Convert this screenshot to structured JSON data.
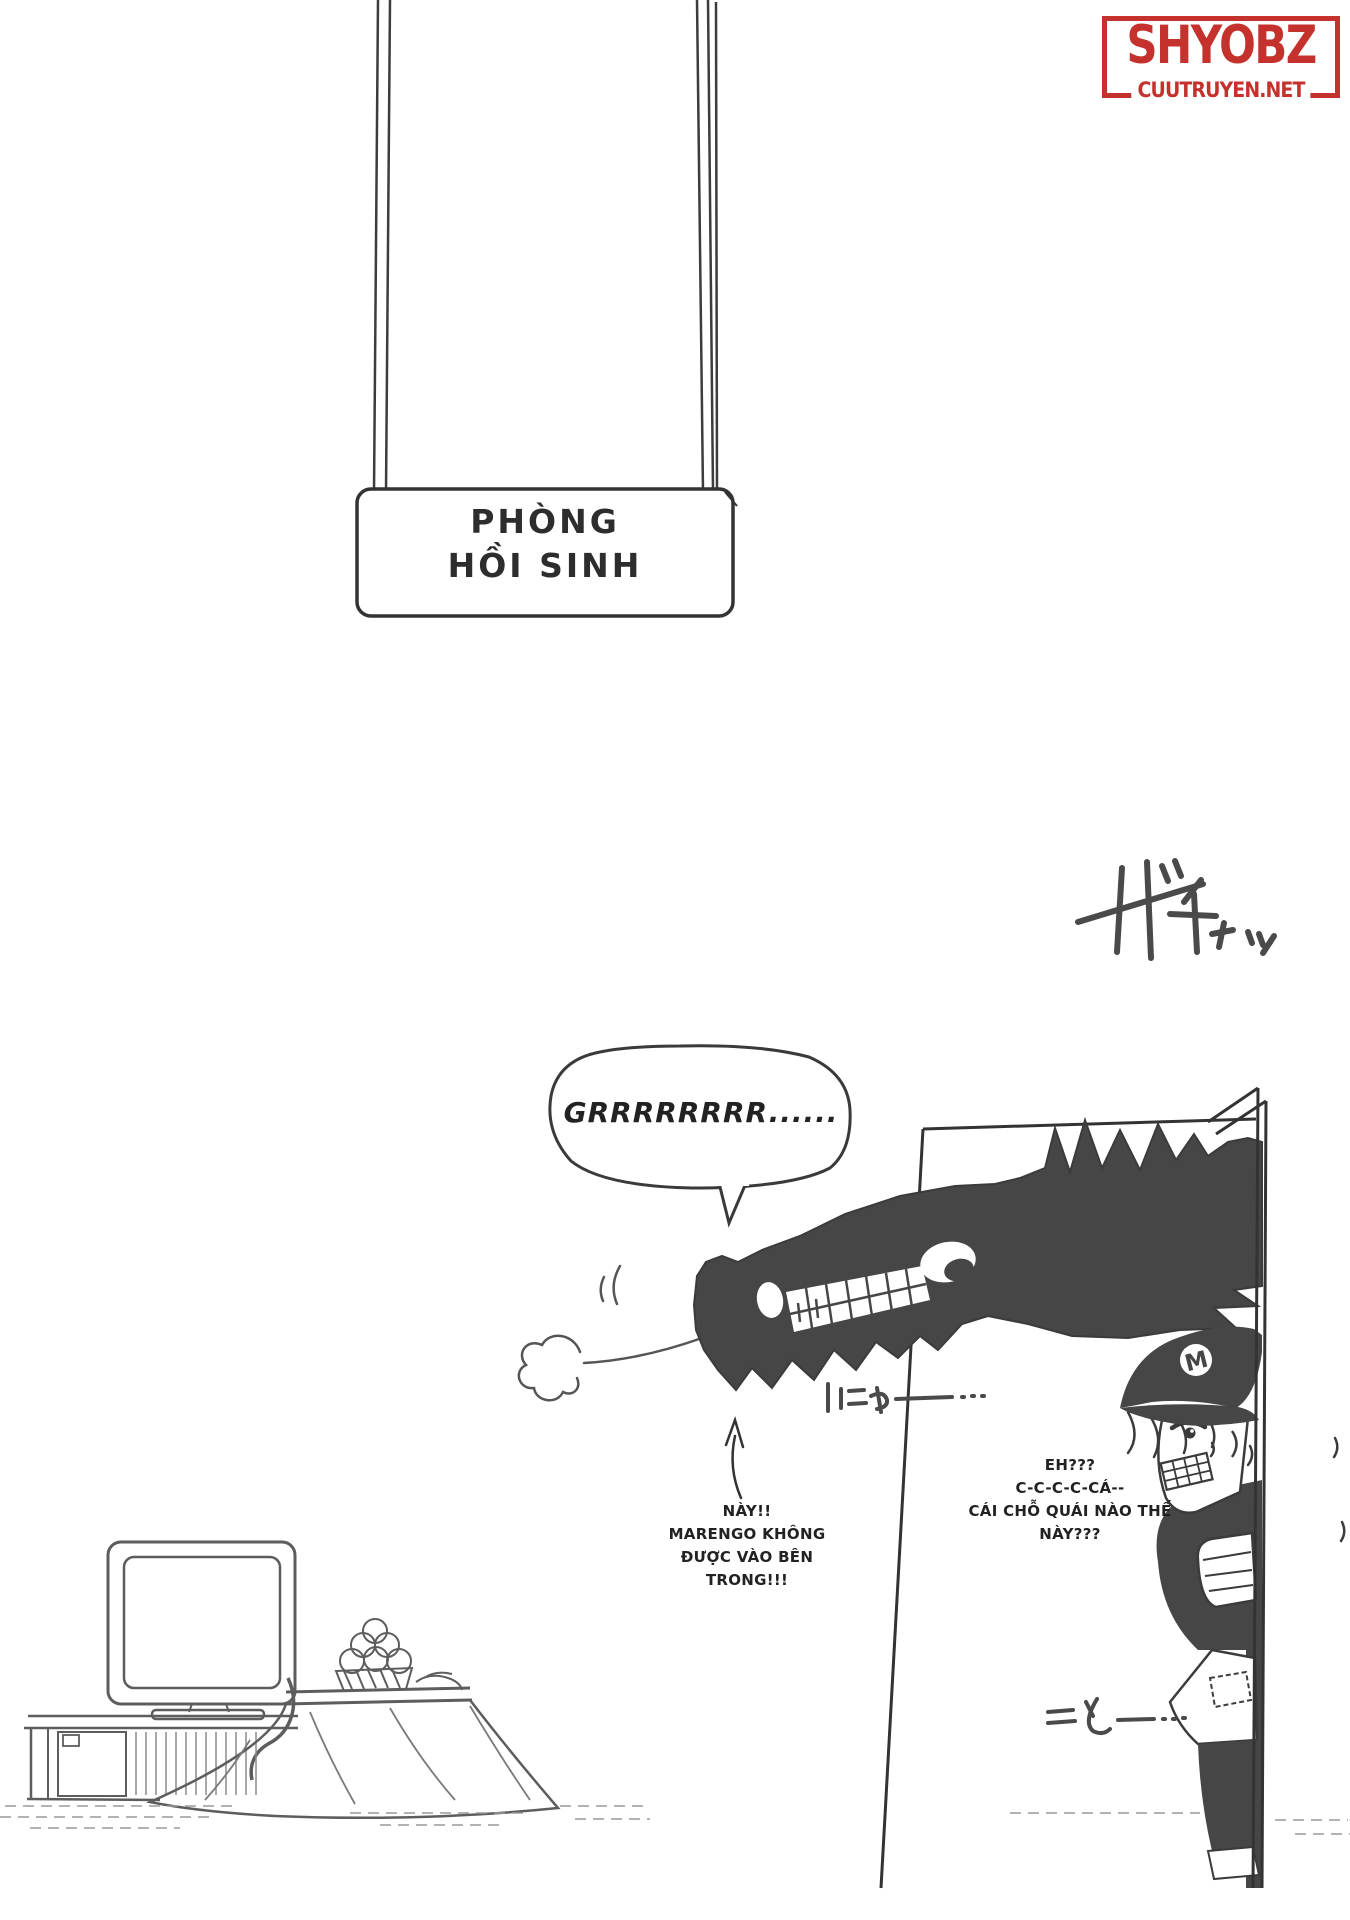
{
  "logo": {
    "title": "SHYOBZ",
    "site": "CUUTRUYEN.NET",
    "color": "#c5322d"
  },
  "sign": {
    "line1": "PHÒNG",
    "line2": "HỒI SINH"
  },
  "speech": {
    "growl": "GRRRRRRRR......"
  },
  "captions": {
    "warning": {
      "line1": "NÀY!!",
      "line2": "MARENGO KHÔNG",
      "line3": "ĐƯỢC VÀO BÊN",
      "line4": "TRONG!!!"
    },
    "scared": {
      "line1": "EH???",
      "line2": "C-C-C-C-CÁ--",
      "line3": "CÁI CHỖ QUÁI NÀO THẾ",
      "line4": "NÀY???"
    }
  },
  "sfx": {
    "door_open": "ガチャッ",
    "grin": "にゃー…",
    "peek": "ことー…"
  },
  "character": {
    "cap_emblem": "M"
  },
  "colors": {
    "ink": "#3b3b3b",
    "silhouette": "#464646",
    "sketch": "#6f6f6f",
    "logo_red": "#c5322d"
  }
}
